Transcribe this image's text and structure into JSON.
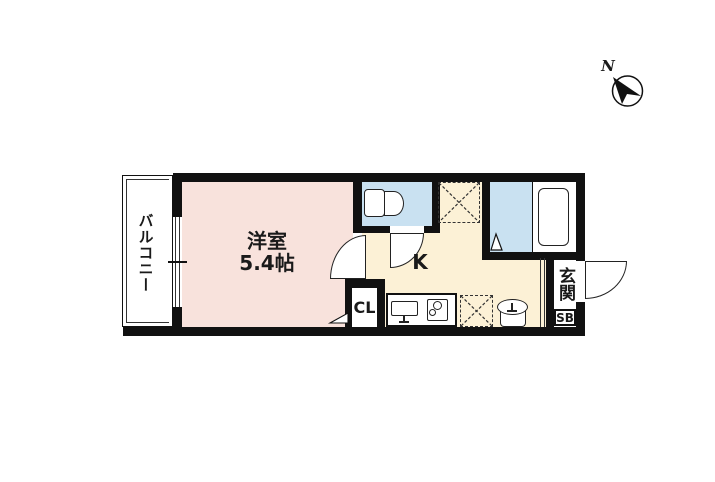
{
  "plan": {
    "type": "apartment-floor-plan",
    "rooms": {
      "balcony": {
        "label": "バルコニー"
      },
      "bedroom": {
        "label": "洋室",
        "size_label": "5.4帖"
      },
      "kitchen": {
        "label": "K"
      },
      "closet": {
        "label": "CL"
      },
      "entrance": {
        "label": "玄関"
      },
      "shoe_box": {
        "label": "SB"
      }
    },
    "compass": {
      "label": "N"
    },
    "fixture_icons": [
      "toilet-icon",
      "bathtub-icon",
      "shower-door-triangle-icon",
      "kitchen-sink-icon",
      "gas-stove-icon",
      "wash-basin-icon",
      "refrigerator-space-x-box",
      "washing-machine-space-x-box",
      "sliding-window-icon",
      "door-swing-arc"
    ],
    "colors": {
      "wall": "#111111",
      "line": "#222222",
      "room_pink": "#f8e2dc",
      "kitchen_cream": "#fcf1d6",
      "water_blue": "#c9e1f1",
      "bg": "#ffffff"
    }
  }
}
